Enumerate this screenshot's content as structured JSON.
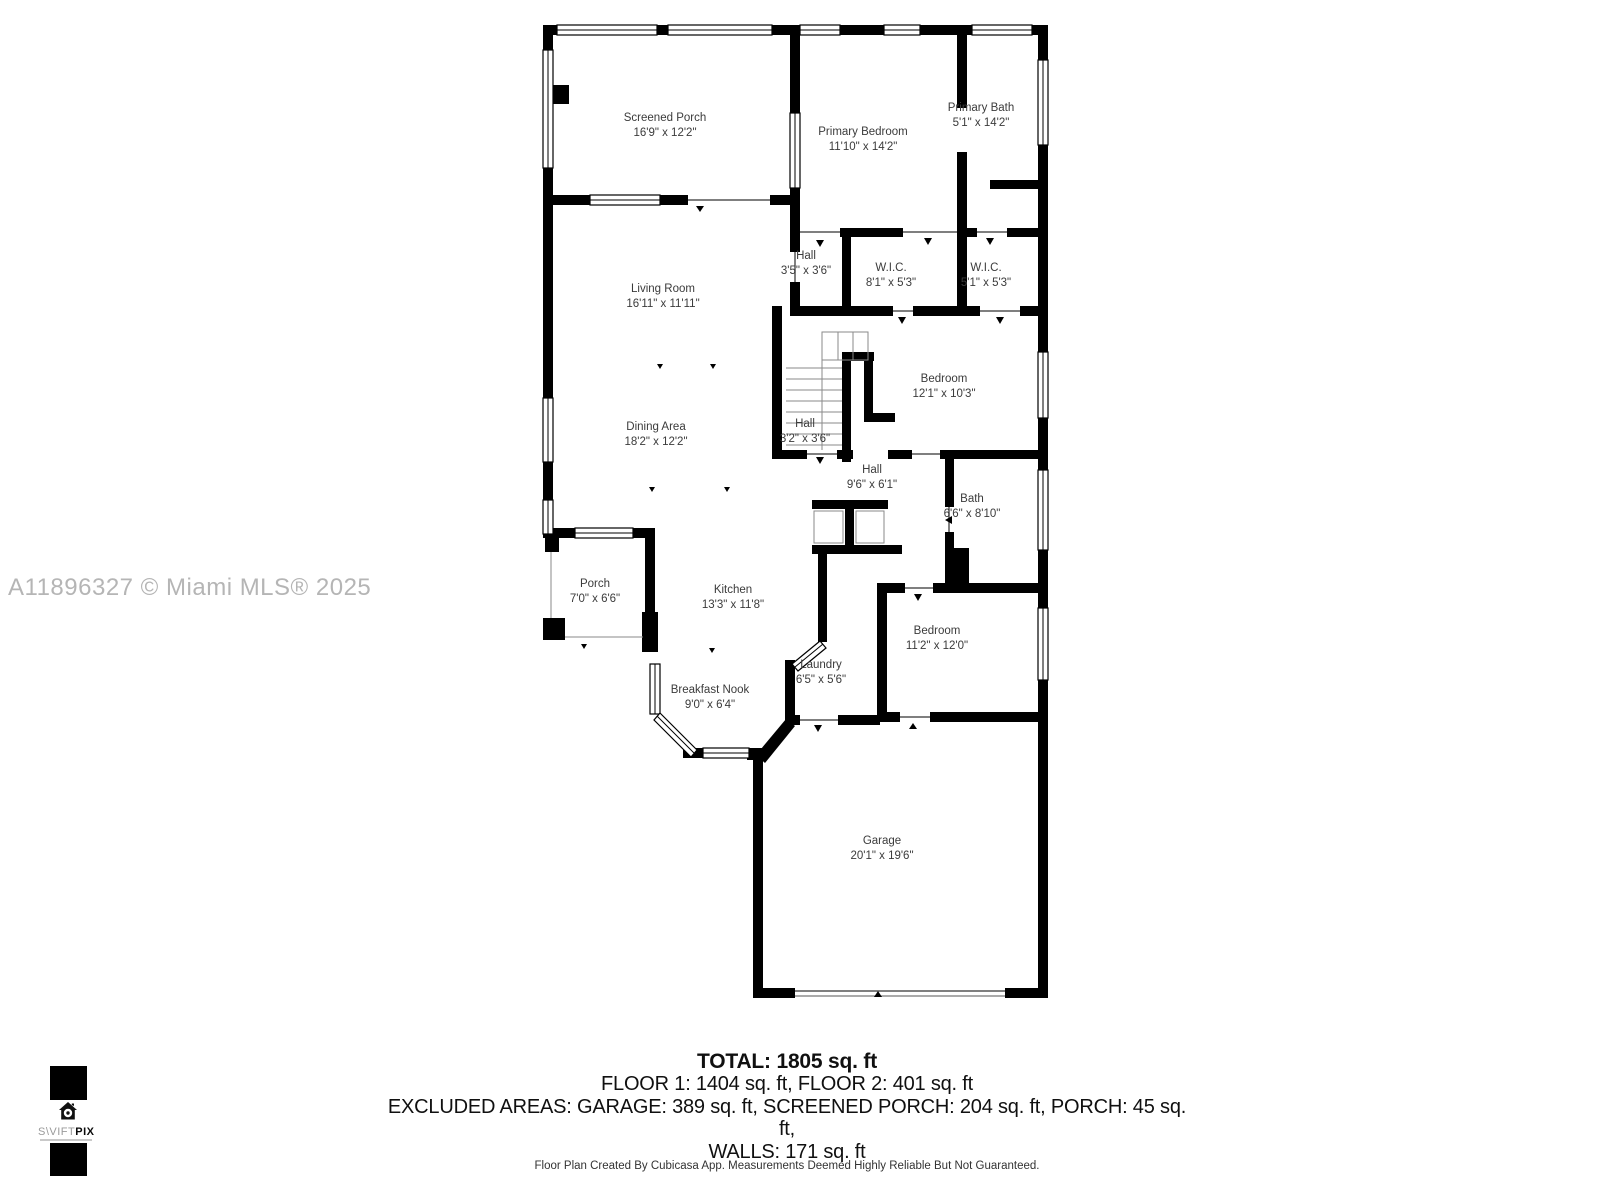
{
  "watermark": "A11896327 © Miami MLS® 2025",
  "rooms": [
    {
      "name": "Screened Porch",
      "dims": "16'9\" x 12'2\""
    },
    {
      "name": "Primary Bedroom",
      "dims": "11'10\" x 14'2\""
    },
    {
      "name": "Primary Bath",
      "dims": "5'1\" x 14'2\""
    },
    {
      "name": "Hall",
      "dims": "3'5\" x 3'6\""
    },
    {
      "name": "W.I.C.",
      "dims": "8'1\" x 5'3\""
    },
    {
      "name": "W.I.C.",
      "dims": "5'1\" x 5'3\""
    },
    {
      "name": "Living Room",
      "dims": "16'11\" x 11'11\""
    },
    {
      "name": "Bedroom",
      "dims": "12'1\" x 10'3\""
    },
    {
      "name": "Dining Area",
      "dims": "18'2\" x 12'2\""
    },
    {
      "name": "Hall",
      "dims": "3'2\" x 3'6\""
    },
    {
      "name": "Hall",
      "dims": "9'6\" x 6'1\""
    },
    {
      "name": "Bath",
      "dims": "6'6\" x 8'10\""
    },
    {
      "name": "Porch",
      "dims": "7'0\" x 6'6\""
    },
    {
      "name": "Kitchen",
      "dims": "13'3\" x 11'8\""
    },
    {
      "name": "Bedroom",
      "dims": "11'2\" x 12'0\""
    },
    {
      "name": "Laundry",
      "dims": "6'5\" x 5'6\""
    },
    {
      "name": "Breakfast Nook",
      "dims": "9'0\" x 6'4\""
    },
    {
      "name": "Garage",
      "dims": "20'1\" x 19'6\""
    }
  ],
  "summary": {
    "total": "TOTAL: 1805 sq. ft",
    "floors": "FLOOR 1: 1404 sq. ft, FLOOR 2: 401 sq. ft",
    "excluded": "EXCLUDED AREAS: GARAGE: 389 sq. ft, SCREENED PORCH: 204 sq. ft, PORCH: 45 sq. ft,",
    "walls": "WALLS: 171 sq. ft"
  },
  "disclaimer": "Floor Plan Created By Cubicasa App. Measurements Deemed Highly Reliable But Not Guaranteed.",
  "logo": {
    "brand_light": "S\\VIFT",
    "brand_bold": "PIX"
  },
  "colors": {
    "wall": "#000000",
    "watermark": "#b5b5b5",
    "label_text": "#3b3b3b"
  }
}
